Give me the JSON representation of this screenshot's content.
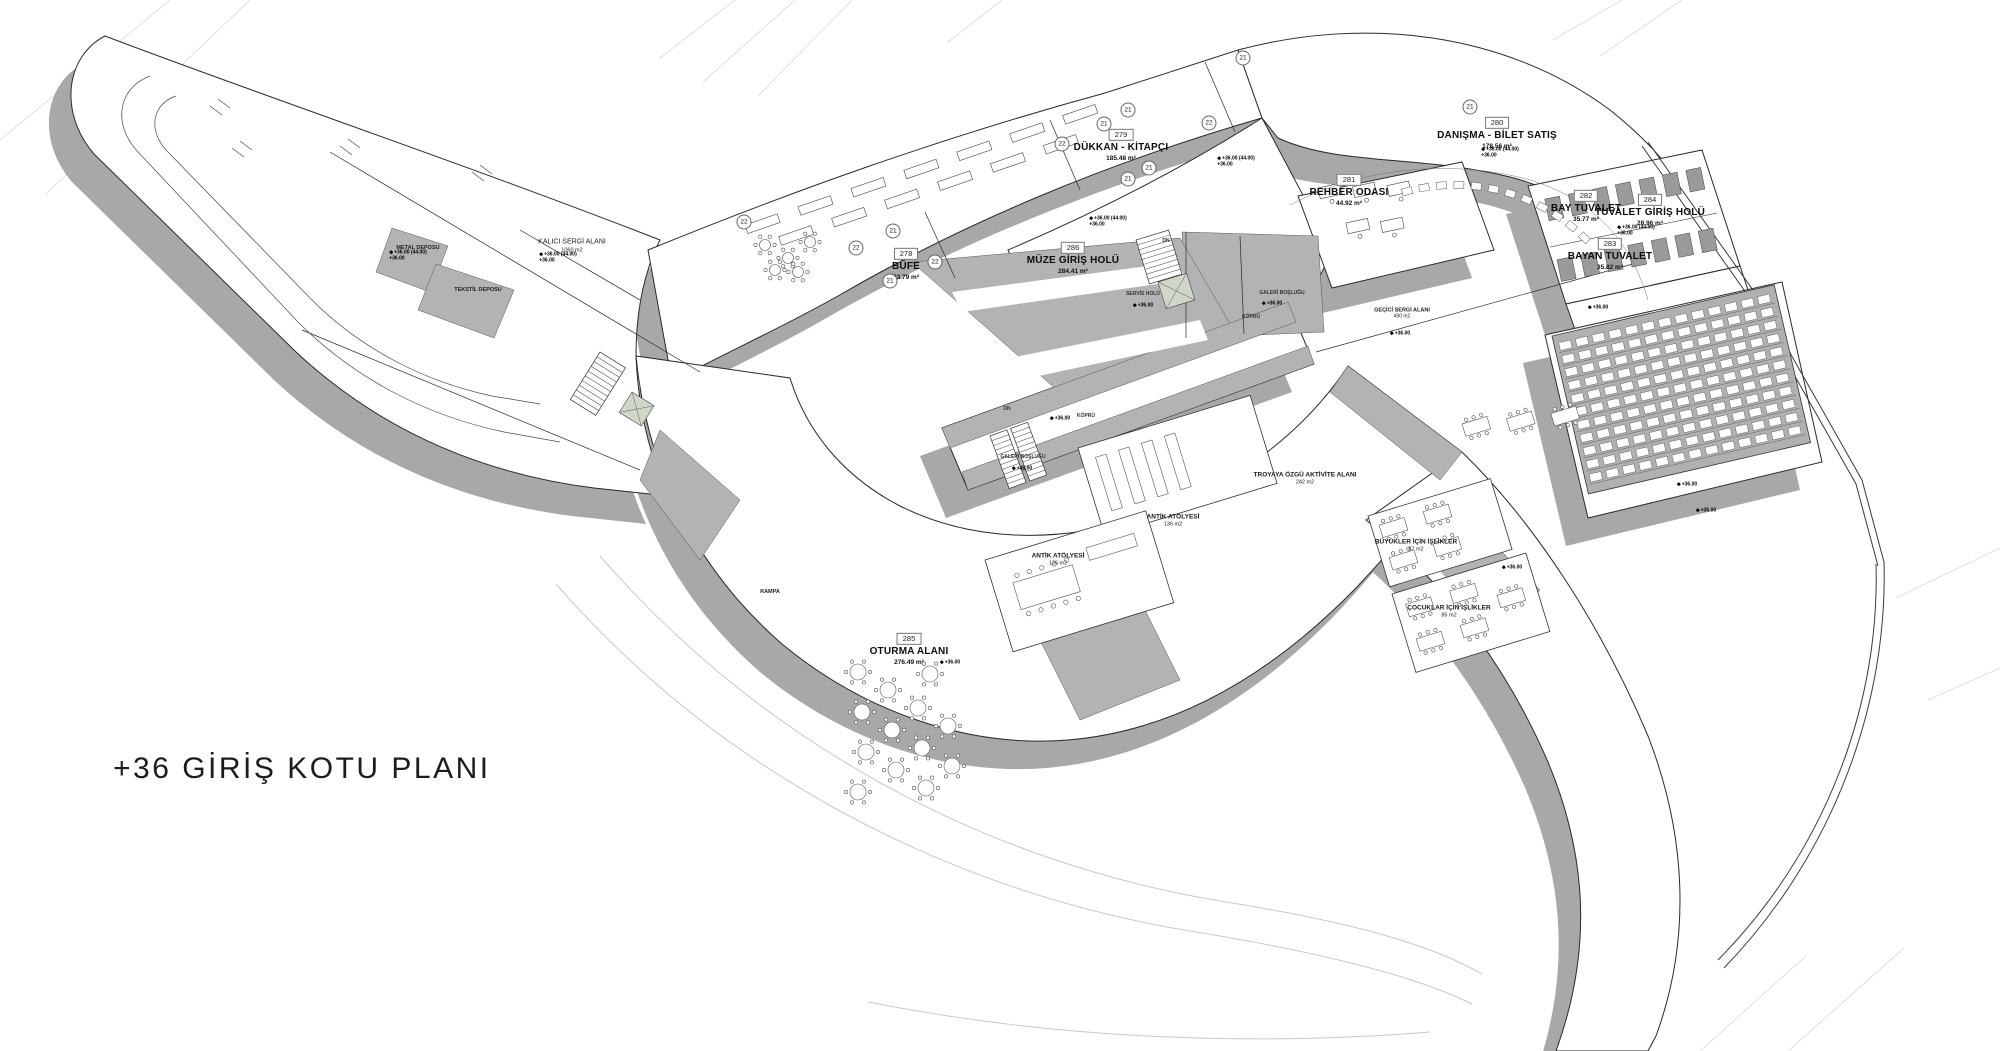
{
  "title": "+36 GİRİŞ KOTU PLANI",
  "rooms": [
    {
      "number": "279",
      "name": "DÜKKAN - KİTAPÇI",
      "area": "185.48 m²"
    },
    {
      "number": "278",
      "name": "BÜFE",
      "area": "83.79 m²"
    },
    {
      "number": "286",
      "name": "MÜZE GİRİŞ HOLÜ",
      "area": "284.41 m²"
    },
    {
      "number": "280",
      "name": "DANIŞMA - BİLET SATIŞ",
      "area": "178.56 m²"
    },
    {
      "number": "281",
      "name": "REHBER ODASI",
      "area": "44.92 m²"
    },
    {
      "number": "282",
      "name": "BAY TUVALET",
      "area": "35.77 m²"
    },
    {
      "number": "284",
      "name": "TUVALET GİRİŞ HOLÜ",
      "area": "28.96 m²"
    },
    {
      "number": "283",
      "name": "BAYAN TUVALET",
      "area": "35.82 m²"
    },
    {
      "number": "285",
      "name": "OTURMA ALANI",
      "area": "276.49 m²"
    }
  ],
  "zones": [
    {
      "name": "KALICI SERGİ ALANI",
      "area": "1060 m2"
    },
    {
      "name": "METAL DEPOSU",
      "area": ""
    },
    {
      "name": "TEKSTİL DEPOSU",
      "area": ""
    },
    {
      "name": "SERVİS HOLÜ",
      "area": ""
    },
    {
      "name": "GALERİ BOŞLUĞU",
      "area": ""
    },
    {
      "name": "KÖPRÜ",
      "area": ""
    },
    {
      "name": "GALERİ BOŞLUĞU",
      "area": ""
    },
    {
      "name": "KÖPRÜ",
      "area": ""
    },
    {
      "name": "GEÇİCİ SERGİ ALANI",
      "area": "490 m2"
    },
    {
      "name": "ANTİK ATÖLYESİ",
      "area": "136 m2"
    },
    {
      "name": "ANTİK ATÖLYESİ",
      "area": "135 m2"
    },
    {
      "name": "TROYAYA ÖZGÜ AKTİVİTE ALANI",
      "area": "242 m2"
    },
    {
      "name": "BÜYÜKLER İÇİN İŞLİKLER",
      "area": "87 m2"
    },
    {
      "name": "ÇOCUKLAR İÇİN İŞLİKLER",
      "area": "85 m2"
    },
    {
      "name": "RAMPA",
      "area": ""
    },
    {
      "name": "DN",
      "area": ""
    },
    {
      "name": "DN",
      "area": ""
    }
  ],
  "markers": {
    "upper": "+36.00 (44.00)",
    "lower": "+36.00",
    "amphi": "+35.00"
  },
  "grid": [
    "21",
    "22"
  ],
  "colors": {
    "background": "#ffffff",
    "shadow": "#a8a8a8",
    "poche": "#b3b3b3",
    "fixture": "#9a9a9a",
    "line": "#2a2a2a",
    "shaft_green": "#cfd8c8",
    "faint": "#d9d9d9"
  }
}
